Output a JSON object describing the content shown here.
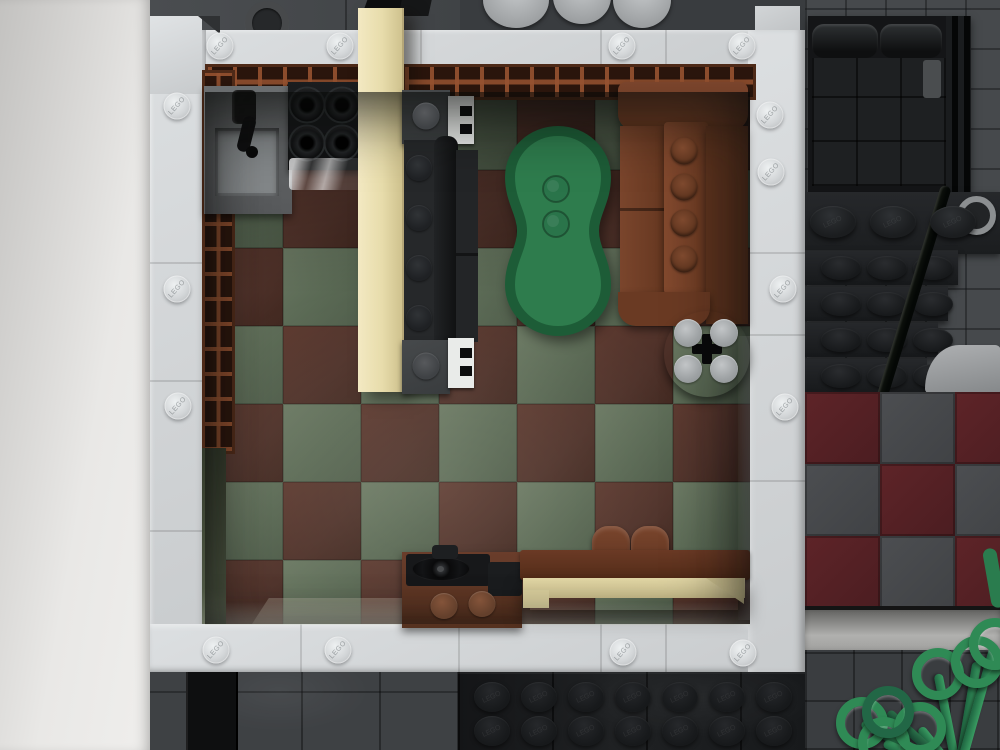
{
  "stud_text": "LEGO",
  "colors": {
    "accent_rug_green": "#2e7c4d",
    "accent_rug_edge": "#1d5c37",
    "floor_green": "#5a6954",
    "floor_brown": "#4e3129",
    "tan_wall": "#e7dcab",
    "sofa_brown": "#6e3b24",
    "red_tile": "#542025",
    "plant_green": "#2f8a55",
    "wall_white": "#d3d6d8"
  },
  "room": {
    "floor": {
      "cols": 7,
      "rows": 7,
      "tile": 78,
      "brown_parity": 0
    }
  },
  "exterior": {
    "red_floor": {
      "tile_w": 75,
      "tile_h": 72,
      "pattern": [
        [
          "r",
          "g",
          "r"
        ],
        [
          "g",
          "r",
          "g"
        ],
        [
          "r",
          "g",
          "r"
        ]
      ]
    },
    "stair_rows": [
      {
        "y": 250,
        "w": 153
      },
      {
        "y": 286,
        "w": 143
      },
      {
        "y": 322,
        "w": 133
      },
      {
        "y": 358,
        "w": 122
      }
    ],
    "bottom_plate_studs": {
      "x0": 492,
      "step": 47,
      "count": 7,
      "rows": [
        697,
        731
      ]
    },
    "plant": {
      "origin": [
        958,
        775
      ],
      "rings": [
        [
          938,
          674,
          0
        ],
        [
          977,
          662,
          0
        ],
        [
          995,
          644,
          0
        ],
        [
          862,
          723,
          0
        ],
        [
          884,
          743,
          0
        ],
        [
          920,
          728,
          0
        ],
        [
          888,
          712,
          1
        ]
      ]
    }
  },
  "stud_groups": [
    {
      "target": "frame-plate-studs",
      "cls": "stud-b",
      "name": "black-plate-stud",
      "text": true,
      "points": [
        [
          833,
          222
        ],
        [
          893,
          222
        ],
        [
          953,
          222
        ]
      ]
    },
    {
      "target": "wall-studs",
      "cls": "stud-w",
      "name": "wall-stud",
      "text": true,
      "points": [
        [
          220,
          46
        ],
        [
          340,
          46
        ],
        [
          622,
          46
        ],
        [
          742,
          46
        ],
        [
          216,
          650
        ],
        [
          338,
          650
        ],
        [
          623,
          652
        ],
        [
          743,
          653
        ],
        [
          177,
          106
        ],
        [
          177,
          289
        ],
        [
          178,
          406
        ],
        [
          770,
          115
        ],
        [
          771,
          172
        ],
        [
          783,
          289
        ],
        [
          785,
          407
        ]
      ]
    },
    {
      "target": "furniture-studs",
      "cls": "stud-t",
      "name": "round-table-stud",
      "points": [
        [
          688,
          333
        ],
        [
          724,
          333
        ],
        [
          688,
          369
        ],
        [
          724,
          369
        ]
      ]
    },
    {
      "target": "furniture-studs",
      "cls": "stud-c",
      "name": "cabinet-stud",
      "points": [
        [
          444,
          606
        ],
        [
          482,
          604
        ]
      ]
    },
    {
      "target": "furniture-studs",
      "cls": "stud-s",
      "name": "brown-sofa-stud",
      "points": [
        [
          684,
          151
        ],
        [
          684,
          187
        ],
        [
          684,
          223
        ],
        [
          684,
          259
        ]
      ]
    },
    {
      "target": "furniture-studs",
      "cls": "stud-k",
      "name": "black-couch-stud",
      "points": [
        [
          419,
          168
        ],
        [
          419,
          218
        ],
        [
          419,
          268
        ],
        [
          419,
          318
        ]
      ]
    },
    {
      "target": "furniture-studs",
      "cls": "stud-g",
      "name": "couch-end-stud",
      "points": [
        [
          426,
          116
        ],
        [
          426,
          366
        ]
      ]
    }
  ]
}
